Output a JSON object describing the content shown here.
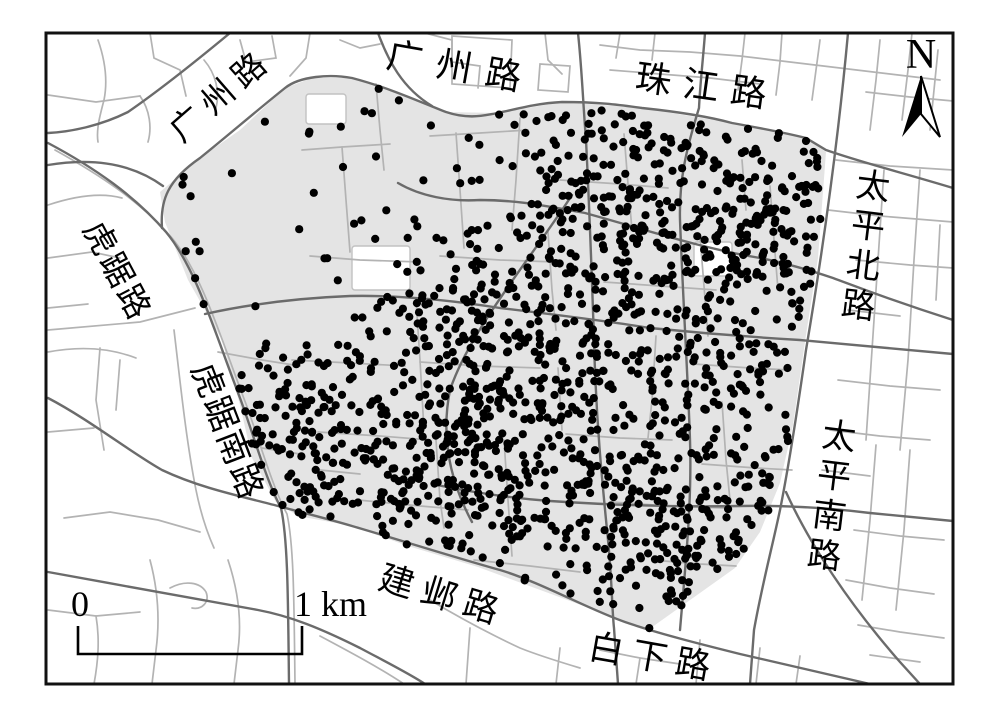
{
  "map": {
    "description_labels": {
      "roads_named": [
        "广州路",
        "广州路",
        "珠江路",
        "太平北路",
        "太平南路",
        "虎踞路",
        "虎踞南路",
        "建邺路",
        "白下路"
      ]
    },
    "colors": {
      "background": "#ffffff",
      "study_fill": "#e4e4e4",
      "minor_road": "#b3b3b3",
      "major_road": "#6b6b6b",
      "dot": "#000000",
      "frame": "#111111",
      "block_stroke": "#c2c2c2"
    },
    "frame": {
      "x": 46,
      "y": 33,
      "width": 907,
      "height": 651,
      "stroke_width": 3
    },
    "study_area": {
      "points": [
        [
          285,
          88
        ],
        [
          312,
          78
        ],
        [
          352,
          78
        ],
        [
          398,
          94
        ],
        [
          446,
          112
        ],
        [
          498,
          113
        ],
        [
          562,
          102
        ],
        [
          642,
          108
        ],
        [
          732,
          123
        ],
        [
          806,
          138
        ],
        [
          826,
          152
        ],
        [
          818,
          258
        ],
        [
          806,
          335
        ],
        [
          793,
          425
        ],
        [
          780,
          483
        ],
        [
          760,
          532
        ],
        [
          735,
          568
        ],
        [
          648,
          630
        ],
        [
          562,
          598
        ],
        [
          478,
          567
        ],
        [
          408,
          546
        ],
        [
          352,
          526
        ],
        [
          298,
          516
        ],
        [
          276,
          502
        ],
        [
          252,
          458
        ],
        [
          240,
          405
        ],
        [
          222,
          340
        ],
        [
          188,
          280
        ],
        [
          165,
          222
        ],
        [
          160,
          192
        ],
        [
          200,
          158
        ],
        [
          240,
          130
        ]
      ]
    },
    "white_blocks": [
      {
        "x": 352,
        "y": 246,
        "w": 58,
        "h": 44
      },
      {
        "x": 306,
        "y": 94,
        "w": 40,
        "h": 30
      },
      {
        "x": 694,
        "y": 242,
        "w": 38,
        "h": 34
      }
    ],
    "roads": {
      "major_width": 2.4,
      "minor_width": 1.7,
      "major": [
        "M48,143 C95,168 135,196 166,232 C196,268 214,330 240,398 C254,436 266,480 281,508 C288,540 288,600 289,684",
        "M162,228 C160,200 168,180 200,158 C225,138 255,112 285,88 C300,76 330,74 352,78 C390,88 420,102 446,112 C470,120 485,115 498,113 C520,108 540,103 562,102 C600,102 620,105 642,108 C680,112 710,117 732,123 C760,128 790,134 806,138 L826,150 C860,162 900,172 953,188",
        "M48,165 C90,158 130,162 163,186",
        "M378,33 C388,60 402,88 432,106",
        "M578,33 C582,70 583,103 586,140 C590,220 592,280 594,340 C596,420 602,480 608,540 C612,580 612,610 614,628 L618,684",
        "M705,33 C703,60 700,85 699,108 C686,150 679,180 680,220 C683,300 688,380 690,440 C692,500 686,560 680,630",
        "M848,33 C840,120 828,220 806,350 C796,420 788,470 780,510 C772,548 762,585 754,630 L750,684",
        "M786,492 C810,545 850,605 900,662 L920,684",
        "M48,398 C90,420 130,452 162,470 C200,488 240,496 278,506 C300,512 325,518 352,526 C400,540 450,556 500,570 C540,582 590,610 625,622 C660,634 700,644 740,654 C780,663 830,675 870,684",
        "M48,572 C120,585 200,600 258,610 C290,616 320,628 360,648 C390,664 410,674 425,684",
        "M398,183 C420,196 450,202 480,200 C520,200 550,207 585,213 C640,228 700,248 760,258 C790,264 815,272 833,278 C860,288 890,300 953,320",
        "M205,314 C250,304 300,298 350,296 C400,295 450,300 500,308 C550,314 600,320 650,328 C700,333 750,337 800,340 C850,345 900,349 953,354",
        "M432,484 C470,492 510,498 550,501 C610,505 680,507 740,506 C790,505 830,508 870,513 C900,516 930,519 953,521",
        "M230,33 C195,62 160,90 128,112 C100,126 70,132 48,133",
        "M572,195 C530,260 470,330 450,390 C440,440 452,485 472,522"
      ],
      "minor": [
        "M55,150 C100,175 141,202 172,238 C202,274 220,336 246,404 C260,442 272,486 287,514 C294,546 294,604 295,684",
        "M174,330 C180,380 186,440 196,490 C200,510 206,530 214,548",
        "M48,330 L140,322 L195,308",
        "M98,40 C105,60 108,80 104,100 C100,115 96,130 98,142",
        "M48,95 L96,102 L140,96",
        "M140,96 C150,110 152,128 148,142",
        "M150,33 L154,58 L180,70 L186,96",
        "M48,205 C75,196 100,192 122,198",
        "M240,40 L246,62 L276,58 L272,36",
        "M204,60 C216,74 220,92 216,108",
        "M310,33 L306,58 L290,76",
        "M340,40 L360,48 L380,44",
        "M425,33 L452,40 L452,62 L480,66 L478,88",
        "M452,36 L512,40 L510,88 L452,84 Z",
        "M540,64 L570,66 L568,92 L538,90 Z",
        "M545,33 L548,60 L562,74",
        "M600,45 L640,50 L690,52 L740,56 L790,62 L840,68 L890,74 L940,80",
        "M610,70 L660,74 L710,78 L760,84",
        "M620,33 L616,58",
        "M655,33 L652,60",
        "M745,33 L742,60 L738,90",
        "M782,33 L780,62 L776,95",
        "M820,40 L816,70 L812,100",
        "M880,40 L876,80 L870,130",
        "M912,33 L908,70 L902,120",
        "M938,50 L934,90 L930,130",
        "M866,92 L910,97 L953,101",
        "M836,160 L890,166 L953,170",
        "M828,210 L880,216 L953,222",
        "M856,260 L910,265 L953,268",
        "M848,310 L900,316",
        "M884,170 L878,260 L872,350 L866,440",
        "M920,170 L914,260 L908,360 L900,450",
        "M940,225 L936,300",
        "M838,380 L890,386 L940,390",
        "M830,430 L880,436 L930,440",
        "M876,445 L870,520 L862,600",
        "M910,450 L904,530 L896,610",
        "M822,470 L870,476",
        "M854,530 L900,536 L944,540",
        "M846,580 L890,588 L934,594",
        "M858,625 L900,632 L944,638",
        "M870,655 L920,662",
        "M150,560 C158,590 160,620 156,650 L152,684",
        "M48,610 L96,616 L140,612",
        "M96,616 C100,640 98,662 94,684",
        "M170,588 C185,580 200,582 206,592 C210,602 202,610 192,608",
        "M228,560 C238,590 242,620 238,650 L234,684",
        "M320,636 C350,652 380,668 404,684",
        "M430,600 C460,618 490,634 520,648 C540,656 560,662 580,668",
        "M470,628 L466,684",
        "M560,648 L556,684",
        "M600,650 L640,658 L680,664",
        "M640,658 L636,684",
        "M700,640 L696,684",
        "M760,648 L756,684",
        "M800,656 L796,684",
        "M48,258 L92,252 L120,258",
        "M48,308 L88,304",
        "M48,352 C80,346 110,348 136,358",
        "M100,348 L96,400 L104,450",
        "M48,432 L94,428",
        "M64,518 L110,512 L158,520 L200,532",
        "M120,360 L116,410",
        "M302,150 L342,147 L390,144",
        "M342,147 L346,200 L350,252",
        "M310,256 L360,260 L420,262",
        "M292,360 L350,363 L405,366",
        "M318,432 L380,436 L430,440",
        "M358,500 L420,506 L468,510",
        "M376,84 L380,130 L384,170",
        "M430,136 L480,133 L528,130",
        "M456,133 L460,190 L464,248",
        "M440,256 L500,260 L556,262",
        "M420,362 L480,366 L540,368",
        "M416,300 L420,360 L424,430",
        "M436,440 L440,500 L444,528",
        "M504,440 L508,500 L512,556",
        "M520,118 L516,180 L512,230",
        "M548,232 L552,290 L556,330",
        "M560,180 L620,184 L668,188",
        "M604,282 L660,286 L716,290",
        "M624,134 L628,184 L632,230",
        "M566,434 L620,438 L672,440",
        "M612,502 L668,506 L724,508",
        "M558,368 L562,430",
        "M656,336 L652,400 L648,438",
        "M700,236 L704,286 L708,336",
        "M722,402 L726,460 L730,500",
        "M742,160 L746,210",
        "M770,186 L774,240 L778,290",
        "M694,364 L750,368 L790,370",
        "M702,464 L756,468 L792,470",
        "M652,560 L700,564 L736,566",
        "M474,560 L530,566 L580,572",
        "M320,470 L360,474",
        "M218,352 L262,360 L300,366",
        "M262,448 L300,454"
      ]
    },
    "labels": [
      {
        "id": "guangzhou-west",
        "text": "广州路",
        "x": 222,
        "y": 96,
        "rot": -41,
        "size": 33,
        "spacing": 8,
        "vertical": false
      },
      {
        "id": "guangzhou-north",
        "text": "广州路",
        "x": 461,
        "y": 68,
        "rot": 10,
        "size": 36,
        "spacing": 14,
        "vertical": false
      },
      {
        "id": "zhujiang",
        "text": "珠江路",
        "x": 707,
        "y": 87,
        "rot": 8,
        "size": 36,
        "spacing": 12,
        "vertical": false
      },
      {
        "id": "taiping-north",
        "text": "太平北路",
        "x": 861,
        "y": 247,
        "rot": 7,
        "size": 34,
        "spacing": 6,
        "vertical": true
      },
      {
        "id": "taiping-south",
        "text": "太平南路",
        "x": 827,
        "y": 497,
        "rot": 7,
        "size": 34,
        "spacing": 6,
        "vertical": true
      },
      {
        "id": "huju",
        "text": "虎踞路",
        "x": 116,
        "y": 272,
        "rot": 62,
        "size": 33,
        "spacing": 3,
        "vertical": false
      },
      {
        "id": "huju-south",
        "text": "虎踞南路",
        "x": 226,
        "y": 432,
        "rot": 69,
        "size": 34,
        "spacing": 2,
        "vertical": false
      },
      {
        "id": "jianye",
        "text": "建邺路",
        "x": 443,
        "y": 596,
        "rot": 17,
        "size": 35,
        "spacing": 9,
        "vertical": false
      },
      {
        "id": "baixia",
        "text": "白下路",
        "x": 654,
        "y": 658,
        "rot": 10,
        "size": 35,
        "spacing": 9,
        "vertical": false
      }
    ],
    "north": {
      "label": "N",
      "x": 921,
      "y": 68,
      "size": 42,
      "arrow": {
        "tip": [
          921,
          76
        ],
        "left": [
          902,
          137
        ],
        "notch": [
          921,
          114
        ],
        "right": [
          940,
          137
        ]
      }
    },
    "scalebar": {
      "zero": "0",
      "unit": "1 km",
      "x1": 78,
      "x2": 302,
      "y_top": 626,
      "y_bottom": 654,
      "label_y": 616,
      "font": 36,
      "stroke_width": 2.6
    },
    "dots": {
      "seed": 20240613,
      "count": 1500,
      "radius": 4.1,
      "uniform_weight": 0.16,
      "clusters": [
        {
          "cx": 470,
          "cy": 420,
          "sigma": 60,
          "w": 0.09
        },
        {
          "cx": 450,
          "cy": 490,
          "sigma": 45,
          "w": 0.06
        },
        {
          "cx": 620,
          "cy": 545,
          "sigma": 60,
          "w": 0.09
        },
        {
          "cx": 680,
          "cy": 195,
          "sigma": 75,
          "w": 0.09
        },
        {
          "cx": 760,
          "cy": 300,
          "sigma": 60,
          "w": 0.06
        },
        {
          "cx": 560,
          "cy": 255,
          "sigma": 60,
          "w": 0.06
        },
        {
          "cx": 350,
          "cy": 470,
          "sigma": 55,
          "w": 0.05
        },
        {
          "cx": 640,
          "cy": 390,
          "sigma": 75,
          "w": 0.08
        },
        {
          "cx": 715,
          "cy": 555,
          "sigma": 50,
          "w": 0.05
        },
        {
          "cx": 610,
          "cy": 128,
          "sigma": 95,
          "w": 0.05
        },
        {
          "cx": 760,
          "cy": 450,
          "sigma": 55,
          "w": 0.03
        },
        {
          "cx": 480,
          "cy": 330,
          "sigma": 50,
          "w": 0.05
        },
        {
          "cx": 788,
          "cy": 215,
          "sigma": 45,
          "w": 0.04
        },
        {
          "cx": 300,
          "cy": 420,
          "sigma": 40,
          "w": 0.04
        }
      ]
    }
  }
}
